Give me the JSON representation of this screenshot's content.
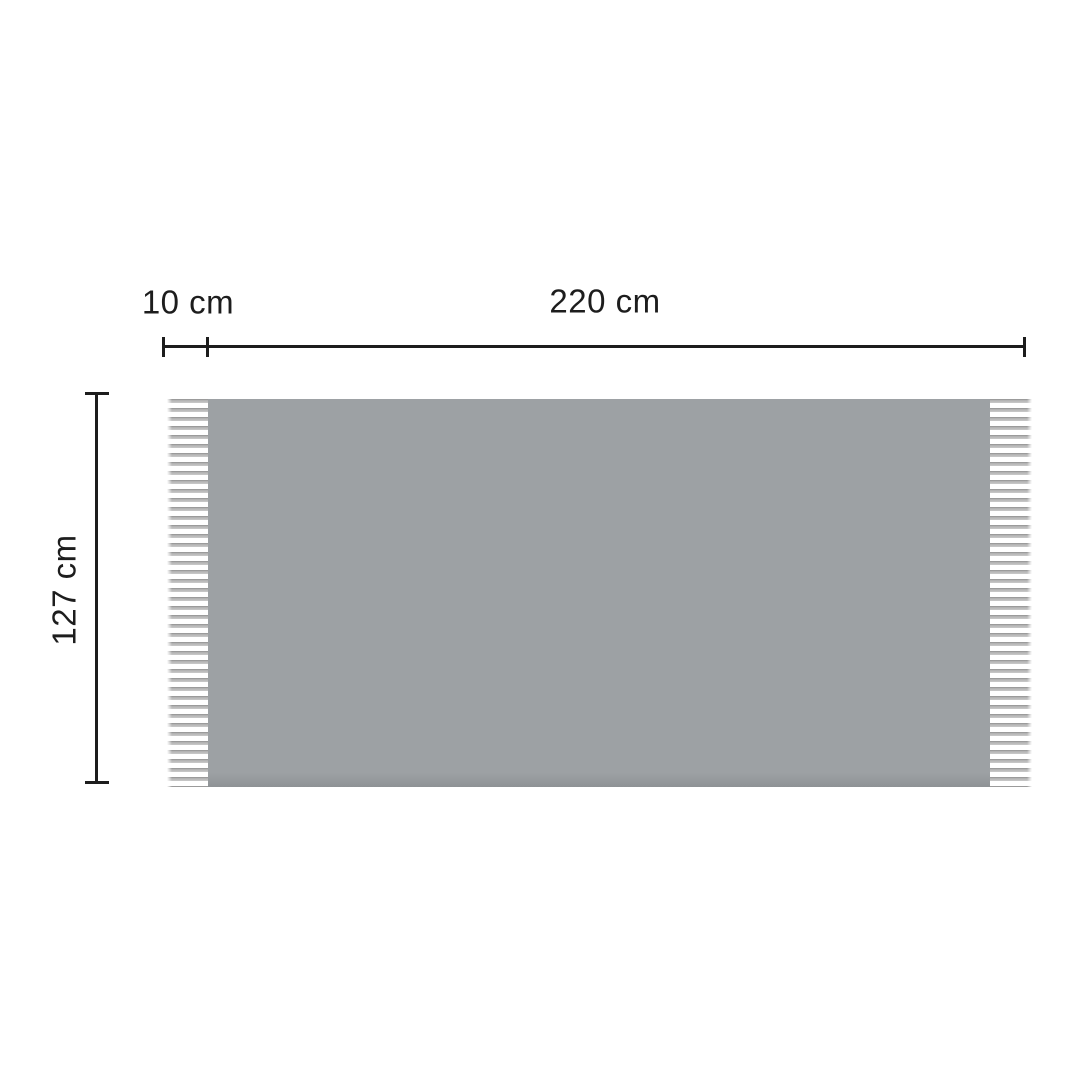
{
  "diagram": {
    "type": "product-dimension-diagram",
    "product": "fringed-blanket-throw",
    "labels": {
      "fringe_width": "10 cm",
      "width": "220 cm",
      "height": "127 cm"
    },
    "measurements": {
      "fringe_width_cm": 10,
      "width_cm": 220,
      "height_cm": 127,
      "unit": "cm"
    }
  },
  "colors": {
    "background": "#ffffff",
    "dimension-line": "#1d1d1d",
    "label-text": "#1d1d1d",
    "blanket-body": "#9da1a4",
    "blanket-shadow": "#8e9295",
    "fringe": "#aeaeae",
    "fringe-dark": "#9b9b9b",
    "fringe-light": "#c9c9c9"
  }
}
